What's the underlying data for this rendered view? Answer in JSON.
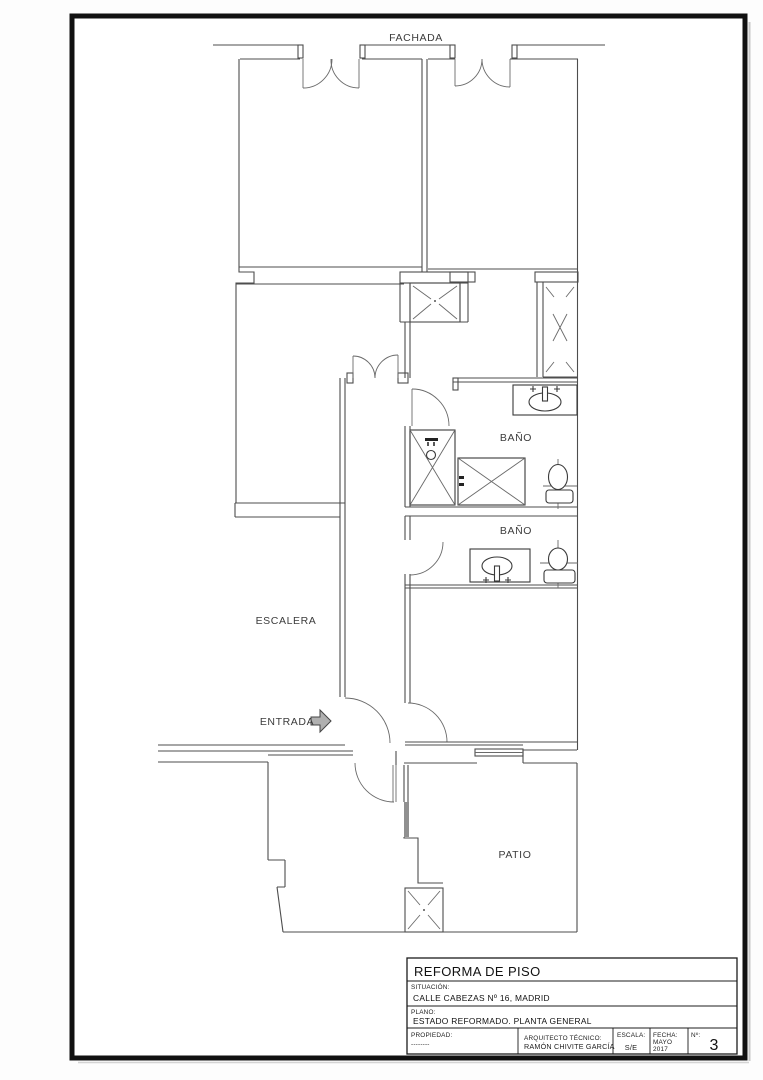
{
  "plan": {
    "fachada_label": "FACHADA",
    "escalera_label": "ESCALERA",
    "entrada_label": "ENTRADA",
    "bano1_label": "BAÑO",
    "bano2_label": "BAÑO",
    "patio_label": "PATIO"
  },
  "title_block": {
    "title": "REFORMA DE PISO",
    "situacion_label": "SITUACIÓN:",
    "situacion_value": "CALLE CABEZAS Nº 16, MADRID",
    "plano_label": "PLANO:",
    "plano_value": "ESTADO REFORMADO. PLANTA GENERAL",
    "propiedad_label": "PROPIEDAD:",
    "propiedad_value": "--------",
    "arquitecto_label": "ARQUITECTO  TÉCNICO:",
    "arquitecto_value": "RAMÓN CHIVITE GARCÍA",
    "escala_label": "ESCALA:",
    "escala_value": "S/E",
    "fecha_label": "FECHA:",
    "fecha_value_1": "MAYO",
    "fecha_value_2": "2017",
    "numero_label": "Nº:",
    "numero_value": "3"
  },
  "colors": {
    "wall": "#4d4d4d",
    "page_border": "#111111",
    "arrow_fill": "#b0b0b0",
    "hatch_fill": "#909090"
  }
}
